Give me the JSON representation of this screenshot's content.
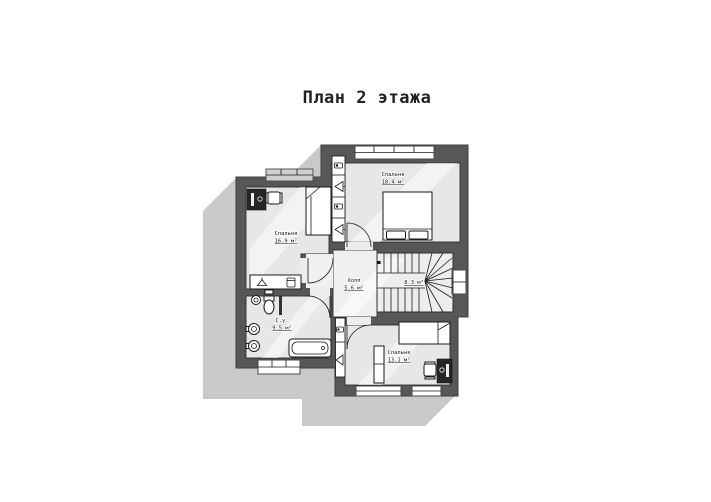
{
  "title": "План 2 этажа",
  "plan": {
    "rooms": {
      "bedroom_top": {
        "name": "Спальня",
        "area": "18.4 м²"
      },
      "bedroom_left": {
        "name": "Спальня",
        "area": "16.9 м²"
      },
      "hall": {
        "name": "Холл",
        "area": "5.6 м²"
      },
      "stairs": {
        "area": "8.3 м²"
      },
      "bathroom": {
        "name": "С.у.",
        "area": "9.5 м²"
      },
      "bedroom_bottom": {
        "name": "Спальня",
        "area": "13.1 м²"
      }
    },
    "colors": {
      "wall": "#575757",
      "floor": "#e7e7e7",
      "hall_floor": "#f0f0f0",
      "shadow": "#c9c9c9",
      "background": "#ffffff",
      "line": "#1a1a1a"
    },
    "icons": [
      "vent-box-icon",
      "vent-flue-icon",
      "bed-icon",
      "desk-icon",
      "chair-icon",
      "hanger-icon",
      "bin-icon",
      "toilet-icon",
      "sink-icon",
      "bathtub-icon",
      "wardrobe-icon",
      "shelf-icon",
      "window-icon",
      "door-arc-icon",
      "stairs-icon"
    ]
  }
}
